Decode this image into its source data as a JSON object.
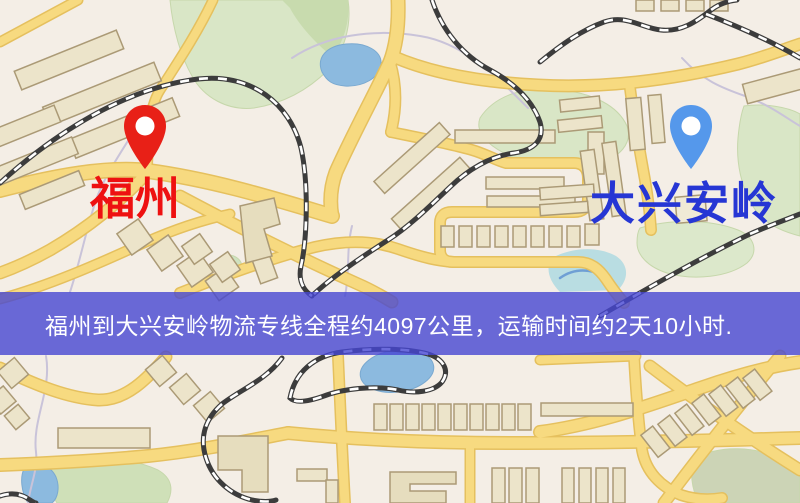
{
  "banner": {
    "text": "福州到大兴安岭物流专线全程约4097公里，运输时间约2天10小时.",
    "background_color": "rgba(70,70,210,0.8)",
    "text_color": "#ffffff",
    "distance_km": "4097",
    "duration": "2天10小时"
  },
  "markers": {
    "origin": {
      "label": "福州",
      "label_color": "#ee1111",
      "pin_color": "#e82017",
      "pin_icon": "location-pin-icon"
    },
    "destination": {
      "label": "大兴安岭",
      "label_color": "#2636d4",
      "pin_color": "#5598eb",
      "pin_icon": "location-pin-icon"
    }
  },
  "map": {
    "colors": {
      "background": "#f4eee6",
      "road_fill": "#f7da80",
      "road_casing": "#e5c05e",
      "park_green": "#d9e6c6",
      "water_blue": "#8cbadf",
      "railway_dark": "#3c3c3c",
      "building_fill": "#ece4ca",
      "building_outline": "#ab9a76"
    }
  }
}
